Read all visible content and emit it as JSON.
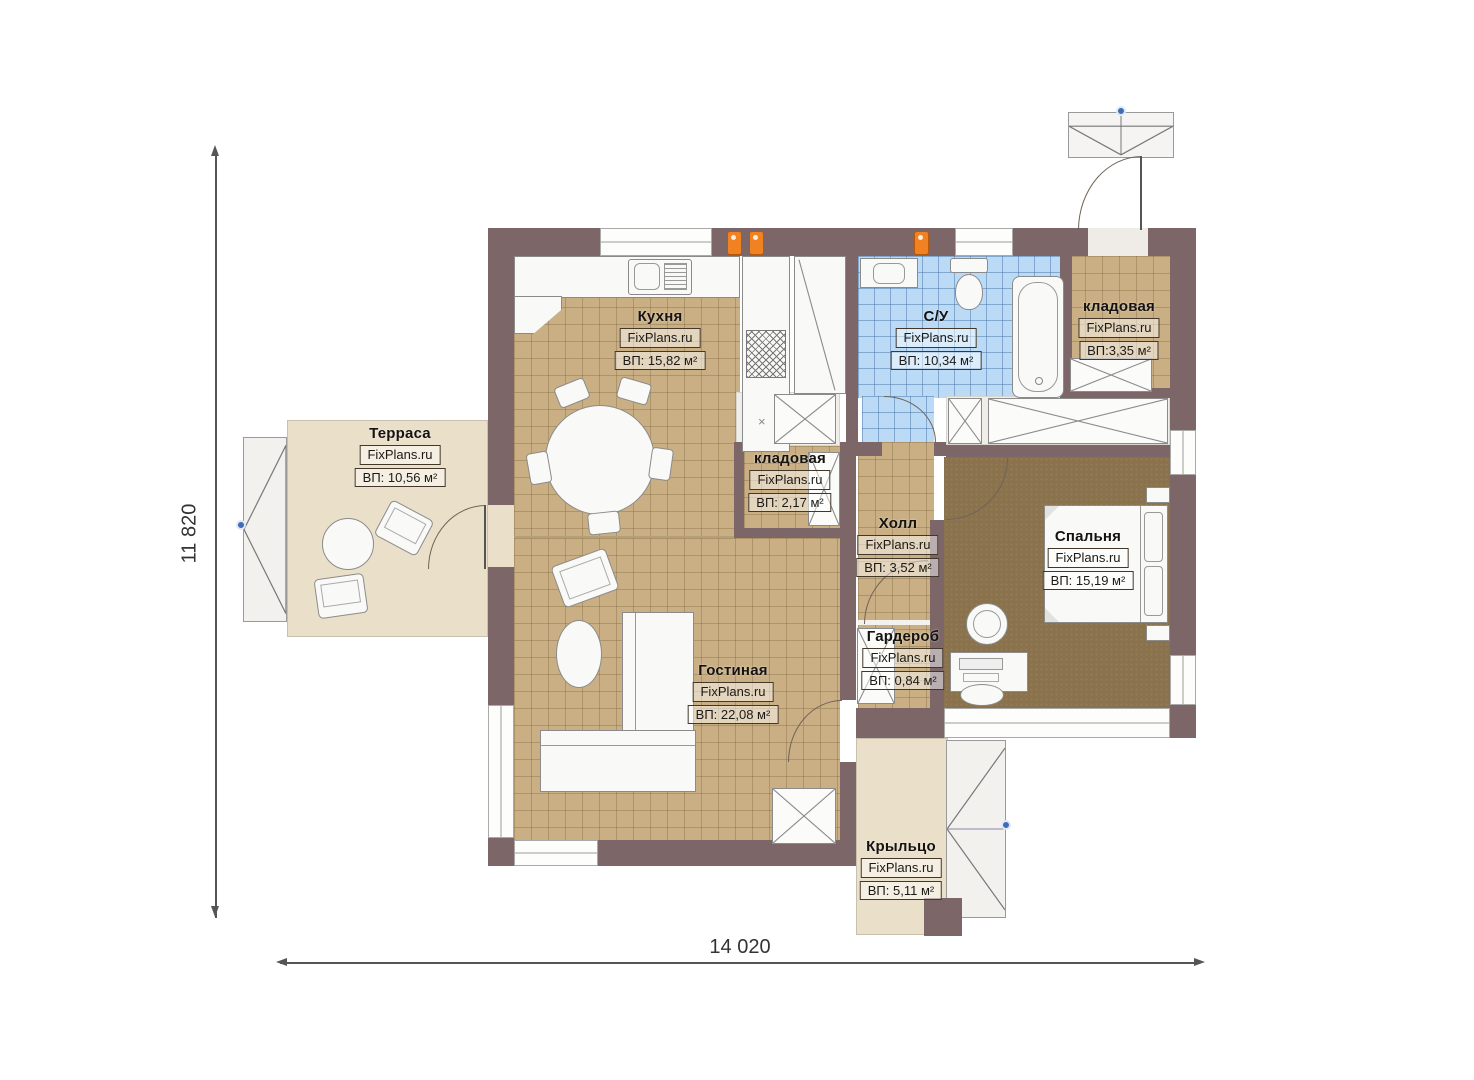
{
  "plan": {
    "dimensions": {
      "height_label": "11 820",
      "width_label": "14 020"
    },
    "watermark": "FixPlans.ru",
    "rooms": [
      {
        "name": "Кухня",
        "watermark": "FixPlans.ru",
        "area": "ВП: 15,82 м²"
      },
      {
        "name": "Терраса",
        "watermark": "FixPlans.ru",
        "area": "ВП: 10,56 м²"
      },
      {
        "name": "С/У",
        "watermark": "FixPlans.ru",
        "area": "ВП: 10,34 м²"
      },
      {
        "name": "кладовая",
        "watermark": "FixPlans.ru",
        "area": "ВП:3,35 м²"
      },
      {
        "name": "кладовая",
        "watermark": "FixPlans.ru",
        "area": "ВП: 2,17 м²"
      },
      {
        "name": "Холл",
        "watermark": "FixPlans.ru",
        "area": "ВП: 3,52 м²"
      },
      {
        "name": "Спальня",
        "watermark": "FixPlans.ru",
        "area": "ВП: 15,19 м²"
      },
      {
        "name": "Гардероб",
        "watermark": "FixPlans.ru",
        "area": "ВП: 0,84 м²"
      },
      {
        "name": "Гостиная",
        "watermark": "FixPlans.ru",
        "area": "ВП: 22,08 м²"
      },
      {
        "name": "Крыльцо",
        "watermark": "FixPlans.ru",
        "area": "ВП: 5,11 м²"
      }
    ],
    "colors": {
      "wall": "#7c6668",
      "tile_floor": "#c9af83",
      "bathroom_tile": "#badaf5",
      "bedroom_floor": "#8a724c",
      "outdoor_floor": "#eadfc9",
      "radiator": "#f08222",
      "handle_dot": "#3f6cb4"
    }
  }
}
